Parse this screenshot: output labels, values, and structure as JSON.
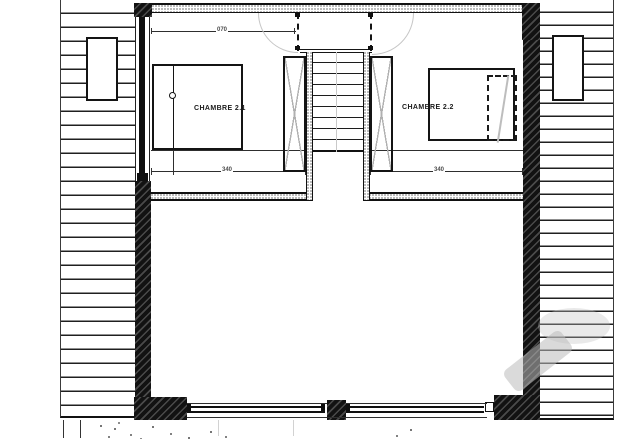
{
  "plan": {
    "rooms": [
      {
        "name": "bedroom-1",
        "label": "CHAMBRE 2.1"
      },
      {
        "name": "bedroom-2",
        "label": "CHAMBRE 2.2"
      }
    ],
    "dimensions": {
      "door_top": "070",
      "room1_width": "340",
      "room2_width": "340"
    },
    "colors": {
      "line": "#1a1a1a",
      "wall_fill": "#101010",
      "swing_arc": "#c6c6c6",
      "crosshatch": "#b0b0b0",
      "watermark": "#bbbbbb",
      "background": "#ffffff"
    }
  }
}
